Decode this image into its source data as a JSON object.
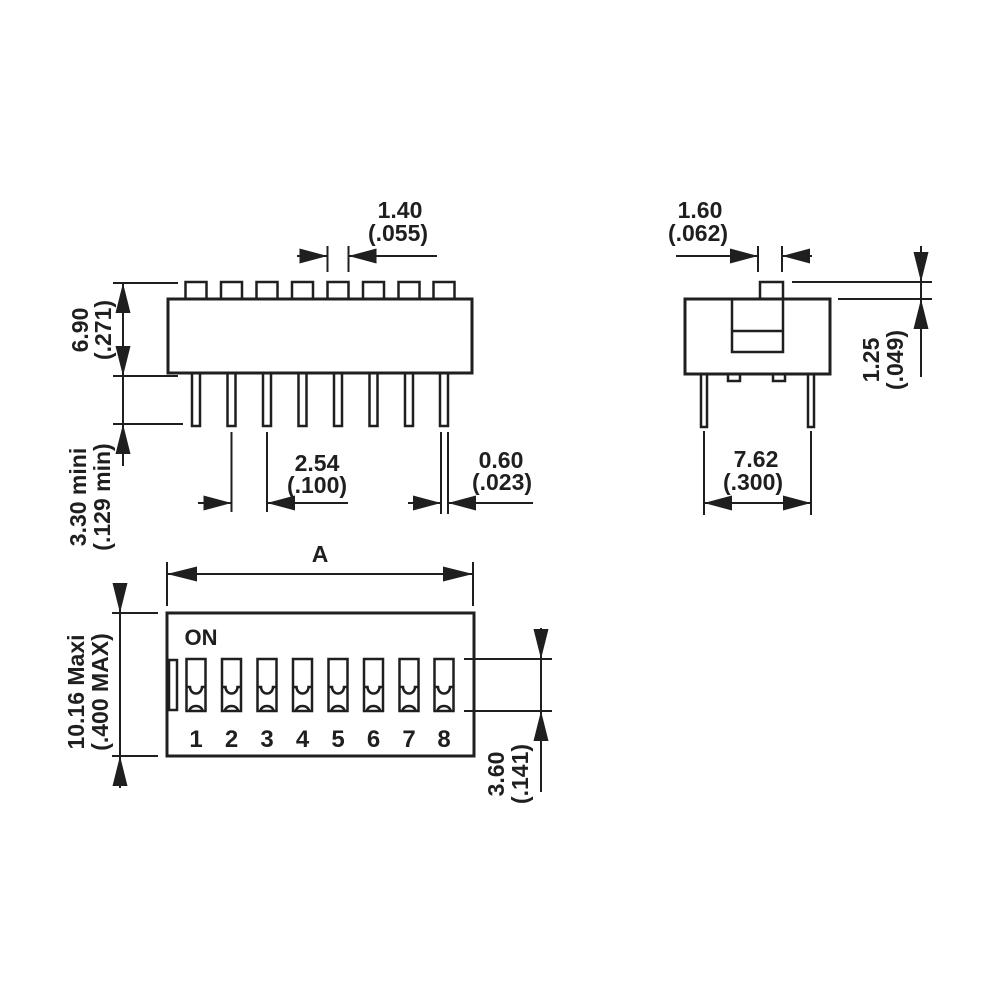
{
  "drawing_title": "DIP switch 8-position dimensional drawing",
  "front_view": {
    "dim_actuator_tab_width": {
      "mm": "1.40",
      "in": "(.055)"
    },
    "dim_body_height": {
      "mm": "6.90",
      "in": "(.271)"
    },
    "dim_pin_length": {
      "mm": "3.30 mini",
      "in": "(.129 min)"
    },
    "dim_pin_pitch": {
      "mm": "2.54",
      "in": "(.100)"
    },
    "dim_pin_width": {
      "mm": "0.60",
      "in": "(.023)"
    }
  },
  "side_view": {
    "dim_actuator_width": {
      "mm": "1.60",
      "in": "(.062)"
    },
    "dim_actuator_height": {
      "mm": "1.25",
      "in": "(.049)"
    },
    "dim_pin_row_spacing": {
      "mm": "7.62",
      "in": "(.300)"
    }
  },
  "top_view": {
    "on_label": "ON",
    "overall_length_label": "A",
    "switch_numbers": [
      "1",
      "2",
      "3",
      "4",
      "5",
      "6",
      "7",
      "8"
    ],
    "dim_body_width": {
      "mm": "10.16 Maxi",
      "in": "(.400 MAX)"
    },
    "dim_slot_length": {
      "mm": "3.60",
      "in": "(.141)"
    }
  },
  "colors": {
    "line": "#1f1f1f",
    "background": "#ffffff"
  }
}
